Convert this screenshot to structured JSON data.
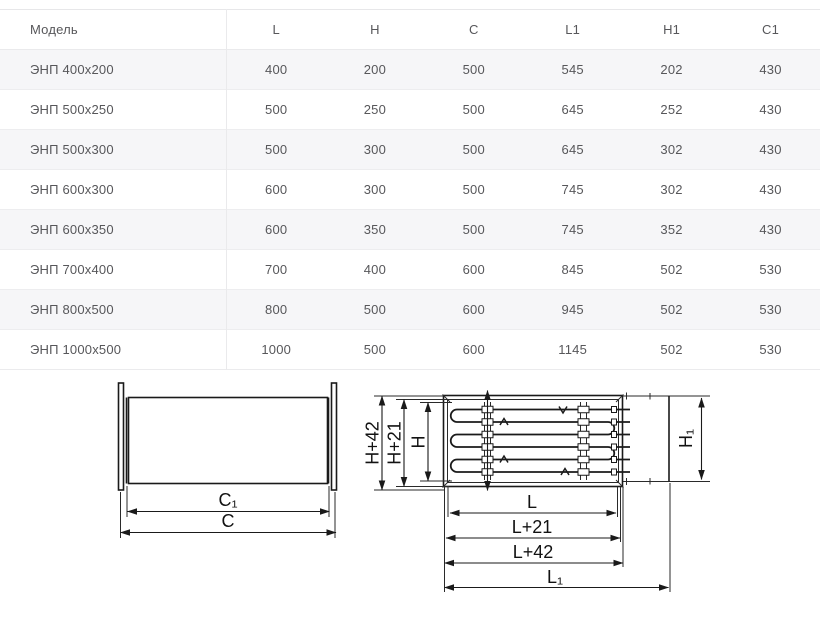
{
  "table": {
    "headers": [
      "Модель",
      "L",
      "H",
      "C",
      "L1",
      "H1",
      "C1"
    ],
    "rows": [
      [
        "ЭНП 400х200",
        "400",
        "200",
        "500",
        "545",
        "202",
        "430"
      ],
      [
        "ЭНП 500х250",
        "500",
        "250",
        "500",
        "645",
        "252",
        "430"
      ],
      [
        "ЭНП 500х300",
        "500",
        "300",
        "500",
        "645",
        "302",
        "430"
      ],
      [
        "ЭНП 600х300",
        "600",
        "300",
        "500",
        "745",
        "302",
        "430"
      ],
      [
        "ЭНП 600х350",
        "600",
        "350",
        "500",
        "745",
        "352",
        "430"
      ],
      [
        "ЭНП 700х400",
        "700",
        "400",
        "600",
        "845",
        "502",
        "530"
      ],
      [
        "ЭНП 800х500",
        "800",
        "500",
        "600",
        "945",
        "502",
        "530"
      ],
      [
        "ЭНП 1000х500",
        "1000",
        "500",
        "600",
        "1145",
        "502",
        "530"
      ]
    ]
  },
  "drawings": {
    "side_view": {
      "dim_c1": "C₁",
      "dim_c": "C"
    },
    "front_view": {
      "dim_h42": "H+42",
      "dim_h21": "H+21",
      "dim_h": "H",
      "dim_h1": "H₁",
      "dim_l": "L",
      "dim_l21": "L+21",
      "dim_l42": "L+42",
      "dim_l1": "L₁"
    }
  },
  "colors": {
    "row_stripe": "#f6f6f8",
    "table_border": "#eaeaec",
    "table_text": "#57575a",
    "drawing_line": "#1a1a1a"
  }
}
